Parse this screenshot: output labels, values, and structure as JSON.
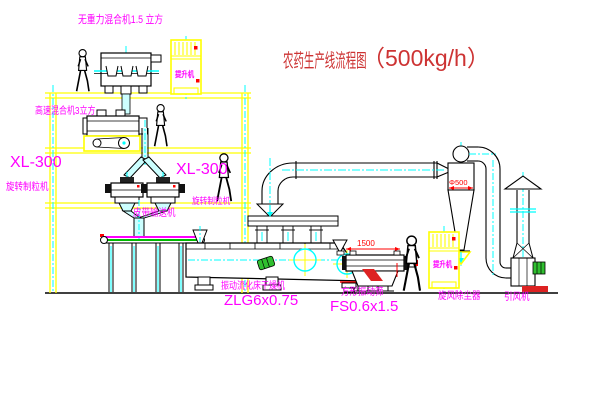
{
  "diagram": {
    "title": {
      "text": "农药生产线流程图",
      "capacity": "（500kg/h）"
    },
    "equipment_labels": {
      "gravity_mixer": "无重力混合机1.5 立方",
      "high_speed_mixer": "高速混合机3立方",
      "granulator_left_model": "XL-300",
      "granulator_left_name": "旋转制粒机",
      "granulator_right_model": "XL-300",
      "granulator_right_name": "旋转制粒机",
      "belt_conveyor": "皮带输送机",
      "elevator_top": "提升机",
      "elevator_bottom": "提升机",
      "dryer_name": "振动流化床干燥机",
      "dryer_model": "ZLG6x0.75",
      "sieve_name": "方形振动筛",
      "sieve_model": "FS0.6x1.5",
      "cyclone": "旋风除尘器",
      "fan": "引风机"
    },
    "dimensions": {
      "sieve_length": "1500",
      "cyclone_diameter": "Φ500"
    },
    "colors": {
      "label": "#ff00ff",
      "title": "#cd3333",
      "structure": "#ffff00",
      "centerline": "#00ffff",
      "dimension": "#ff0000",
      "outline": "#000000",
      "motor": "#2fbf2f"
    }
  }
}
